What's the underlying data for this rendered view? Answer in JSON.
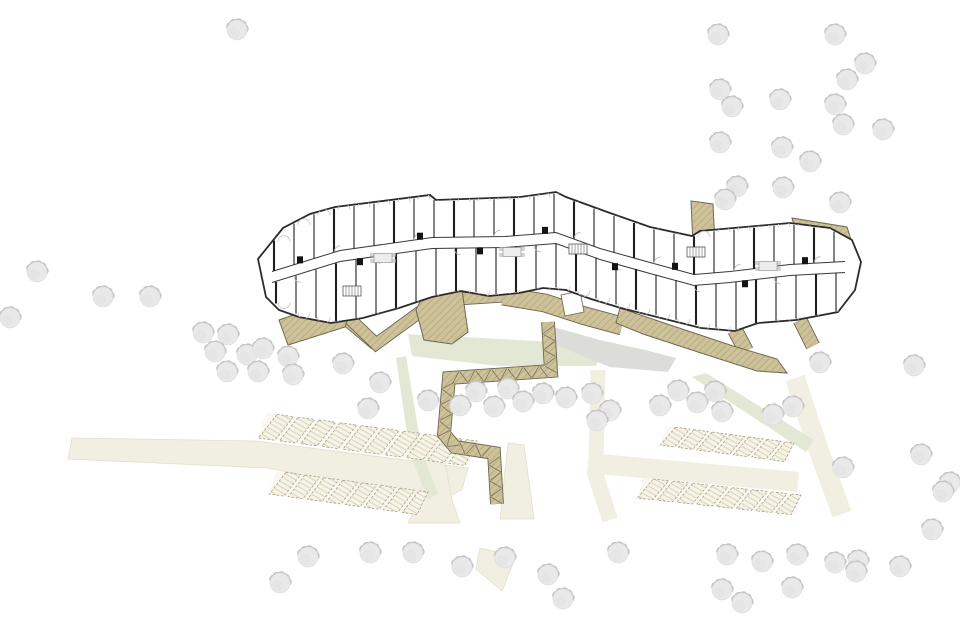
{
  "canvas": {
    "w": 960,
    "h": 639,
    "bg": "#ffffff"
  },
  "colors": {
    "cream": "#f1efe1",
    "cream_edge": "#e2dfc9",
    "green": "#e2e8d4",
    "gray": "#dcdcd8",
    "deck": "#cec29b",
    "deck_hatch": "#b2a578",
    "deck_edge": "#6b6350",
    "stall_fill": "#f6f4e9",
    "stall_line": "#a89d80",
    "stall_hatch": "#d9d1b3",
    "wall": "#2b2b2b",
    "partition": "#1f1f1f",
    "corridor_wall": "#3a3a3a",
    "arc": "#c7c7c7",
    "door_arc": "#b5b5b5",
    "furn_fill": "#ededeb",
    "furn_edge": "#999999",
    "tree_fill": "#e9e9e9",
    "tree_shadow": "#c4c4c4",
    "tree_edge": "#dadada"
  },
  "cream_polys": [
    [
      [
        72,
        438
      ],
      [
        256,
        441
      ],
      [
        468,
        468
      ],
      [
        462,
        490
      ],
      [
        436,
        502
      ],
      [
        268,
        468
      ],
      [
        68,
        459
      ]
    ],
    [
      [
        428,
        445
      ],
      [
        442,
        447
      ],
      [
        452,
        500
      ],
      [
        460,
        523
      ],
      [
        408,
        523
      ],
      [
        420,
        500
      ]
    ],
    [
      [
        508,
        443
      ],
      [
        524,
        445
      ],
      [
        534,
        519
      ],
      [
        500,
        519
      ]
    ],
    [
      [
        480,
        548
      ],
      [
        516,
        556
      ],
      [
        502,
        591
      ],
      [
        476,
        569
      ]
    ]
  ],
  "cream_bands": [
    {
      "pts": [
        [
          598,
          370
        ],
        [
          596,
          462
        ]
      ],
      "w": 15
    },
    {
      "pts": [
        [
          588,
          463
        ],
        [
          798,
          482
        ]
      ],
      "w": 20
    },
    {
      "pts": [
        [
          795,
          378
        ],
        [
          818,
          448
        ],
        [
          842,
          514
        ]
      ],
      "w": 20
    },
    {
      "pts": [
        [
          594,
          470
        ],
        [
          610,
          520
        ]
      ],
      "w": 16
    }
  ],
  "green_polys": [
    [
      [
        408,
        334
      ],
      [
        555,
        342
      ],
      [
        600,
        356
      ],
      [
        596,
        366
      ],
      [
        498,
        366
      ],
      [
        412,
        356
      ]
    ],
    [
      [
        396,
        358
      ],
      [
        406,
        356
      ],
      [
        422,
        452
      ],
      [
        438,
        494
      ],
      [
        428,
        499
      ],
      [
        410,
        454
      ]
    ],
    [
      [
        692,
        377
      ],
      [
        706,
        373
      ],
      [
        814,
        440
      ],
      [
        806,
        452
      ]
    ]
  ],
  "gray_polys": [
    [
      [
        546,
        325
      ],
      [
        600,
        340
      ],
      [
        645,
        350
      ],
      [
        676,
        358
      ],
      [
        668,
        372
      ],
      [
        610,
        367
      ],
      [
        556,
        345
      ]
    ]
  ],
  "parking_rows": [
    {
      "quad": [
        [
          266,
          413
        ],
        [
          477,
          441
        ],
        [
          469,
          466
        ],
        [
          258,
          438
        ]
      ],
      "stalls": 10
    },
    {
      "quad": [
        [
          276,
          471
        ],
        [
          428,
          492
        ],
        [
          421,
          515
        ],
        [
          269,
          494
        ]
      ],
      "stalls": 8
    },
    {
      "quad": [
        [
          666,
          426
        ],
        [
          794,
          443
        ],
        [
          788,
          462
        ],
        [
          660,
          445
        ]
      ],
      "stalls": 7
    },
    {
      "quad": [
        [
          643,
          478
        ],
        [
          801,
          495
        ],
        [
          795,
          515
        ],
        [
          637,
          498
        ]
      ],
      "stalls": 8
    }
  ],
  "deck_polys": [
    [
      [
        279,
        320
      ],
      [
        333,
        301
      ],
      [
        352,
        307
      ],
      [
        345,
        327
      ],
      [
        288,
        345
      ]
    ],
    [
      [
        792,
        218
      ],
      [
        847,
        227
      ],
      [
        853,
        246
      ],
      [
        798,
        238
      ]
    ],
    [
      [
        691,
        201
      ],
      [
        713,
        204
      ],
      [
        715,
        247
      ],
      [
        693,
        245
      ]
    ],
    [
      [
        616,
        323
      ],
      [
        620,
        308
      ],
      [
        670,
        325
      ],
      [
        733,
        346
      ],
      [
        777,
        359
      ],
      [
        787,
        373
      ],
      [
        757,
        371
      ],
      [
        698,
        352
      ],
      [
        643,
        334
      ]
    ],
    [
      [
        428,
        285
      ],
      [
        462,
        290
      ],
      [
        468,
        332
      ],
      [
        452,
        344
      ],
      [
        424,
        340
      ],
      [
        416,
        310
      ]
    ]
  ],
  "deck_bands": [
    {
      "pts": [
        [
          318,
          293
        ],
        [
          338,
          312
        ],
        [
          376,
          344
        ]
      ],
      "w": 12
    },
    {
      "pts": [
        [
          348,
          317
        ],
        [
          376,
          344
        ],
        [
          420,
          312
        ],
        [
          458,
          299
        ],
        [
          505,
          296
        ]
      ],
      "w": 11
    },
    {
      "pts": [
        [
          503,
          296
        ],
        [
          545,
          303
        ],
        [
          585,
          316
        ],
        [
          622,
          326
        ]
      ],
      "w": 17
    },
    {
      "pts": [
        [
          735,
          330
        ],
        [
          746,
          351
        ]
      ],
      "w": 14
    },
    {
      "pts": [
        [
          800,
          320
        ],
        [
          813,
          346
        ]
      ],
      "w": 13
    }
  ],
  "boardwalk": {
    "pts": [
      [
        548,
        322
      ],
      [
        551,
        371
      ],
      [
        449,
        378
      ],
      [
        444,
        434
      ],
      [
        455,
        447
      ],
      [
        494,
        453
      ],
      [
        497,
        504
      ]
    ],
    "w": 12
  },
  "deck_hole": [
    [
      561,
      295
    ],
    [
      580,
      291
    ],
    [
      584,
      312
    ],
    [
      565,
      316
    ]
  ],
  "building": {
    "outline": [
      [
        258,
        259
      ],
      [
        283,
        228
      ],
      [
        310,
        214
      ],
      [
        335,
        207
      ],
      [
        430,
        195
      ],
      [
        436,
        200
      ],
      [
        520,
        197
      ],
      [
        556,
        192
      ],
      [
        566,
        197
      ],
      [
        610,
        213
      ],
      [
        650,
        227
      ],
      [
        692,
        236
      ],
      [
        700,
        231
      ],
      [
        790,
        223
      ],
      [
        830,
        228
      ],
      [
        852,
        240
      ],
      [
        861,
        262
      ],
      [
        855,
        290
      ],
      [
        838,
        312
      ],
      [
        796,
        320
      ],
      [
        758,
        323
      ],
      [
        735,
        331
      ],
      [
        701,
        328
      ],
      [
        661,
        318
      ],
      [
        621,
        308
      ],
      [
        591,
        299
      ],
      [
        566,
        290
      ],
      [
        543,
        288
      ],
      [
        519,
        293
      ],
      [
        489,
        296
      ],
      [
        461,
        291
      ],
      [
        432,
        297
      ],
      [
        399,
        308
      ],
      [
        363,
        318
      ],
      [
        331,
        323
      ],
      [
        299,
        317
      ],
      [
        279,
        310
      ],
      [
        266,
        297
      ]
    ],
    "top_count": 17,
    "corridor": [
      [
        272,
        277
      ],
      [
        340,
        256
      ],
      [
        432,
        243
      ],
      [
        505,
        242
      ],
      [
        556,
        238
      ],
      [
        600,
        254
      ],
      [
        650,
        268
      ],
      [
        694,
        280
      ],
      [
        730,
        277
      ],
      [
        790,
        270
      ],
      [
        845,
        267
      ]
    ],
    "partition_step": 20,
    "partition_x0": 274,
    "partition_x1": 848,
    "block_xs": [
      300,
      360,
      420,
      480,
      545,
      615,
      675,
      745,
      805
    ],
    "stairs": [
      [
        352,
        291
      ],
      [
        578,
        249
      ],
      [
        696,
        252
      ]
    ],
    "tables": [
      [
        383,
        258
      ],
      [
        512,
        252
      ],
      [
        768,
        266
      ]
    ]
  },
  "trees": {
    "r": 10,
    "pos": [
      [
        237,
        30
      ],
      [
        718,
        35
      ],
      [
        835,
        35
      ],
      [
        865,
        64
      ],
      [
        847,
        80
      ],
      [
        720,
        90
      ],
      [
        732,
        107
      ],
      [
        780,
        100
      ],
      [
        835,
        105
      ],
      [
        883,
        130
      ],
      [
        843,
        125
      ],
      [
        720,
        143
      ],
      [
        782,
        148
      ],
      [
        810,
        162
      ],
      [
        737,
        187
      ],
      [
        725,
        200
      ],
      [
        783,
        188
      ],
      [
        840,
        203
      ],
      [
        37,
        272
      ],
      [
        10,
        318
      ],
      [
        103,
        297
      ],
      [
        150,
        297
      ],
      [
        203,
        333
      ],
      [
        228,
        335
      ],
      [
        215,
        352
      ],
      [
        247,
        355
      ],
      [
        263,
        349
      ],
      [
        227,
        372
      ],
      [
        258,
        372
      ],
      [
        288,
        357
      ],
      [
        293,
        375
      ],
      [
        343,
        364
      ],
      [
        380,
        383
      ],
      [
        368,
        409
      ],
      [
        428,
        401
      ],
      [
        460,
        406
      ],
      [
        476,
        392
      ],
      [
        494,
        407
      ],
      [
        508,
        389
      ],
      [
        523,
        402
      ],
      [
        543,
        394
      ],
      [
        566,
        398
      ],
      [
        592,
        394
      ],
      [
        610,
        411
      ],
      [
        597,
        421
      ],
      [
        660,
        406
      ],
      [
        678,
        391
      ],
      [
        697,
        403
      ],
      [
        715,
        392
      ],
      [
        722,
        412
      ],
      [
        773,
        415
      ],
      [
        793,
        407
      ],
      [
        820,
        363
      ],
      [
        914,
        366
      ],
      [
        843,
        468
      ],
      [
        921,
        455
      ],
      [
        950,
        483
      ],
      [
        308,
        557
      ],
      [
        280,
        583
      ],
      [
        370,
        553
      ],
      [
        413,
        553
      ],
      [
        462,
        567
      ],
      [
        505,
        558
      ],
      [
        548,
        575
      ],
      [
        563,
        599
      ],
      [
        618,
        553
      ],
      [
        727,
        555
      ],
      [
        762,
        562
      ],
      [
        797,
        555
      ],
      [
        835,
        563
      ],
      [
        858,
        561
      ],
      [
        856,
        572
      ],
      [
        900,
        567
      ],
      [
        932,
        530
      ],
      [
        943,
        492
      ],
      [
        722,
        590
      ],
      [
        742,
        603
      ],
      [
        792,
        588
      ]
    ]
  }
}
